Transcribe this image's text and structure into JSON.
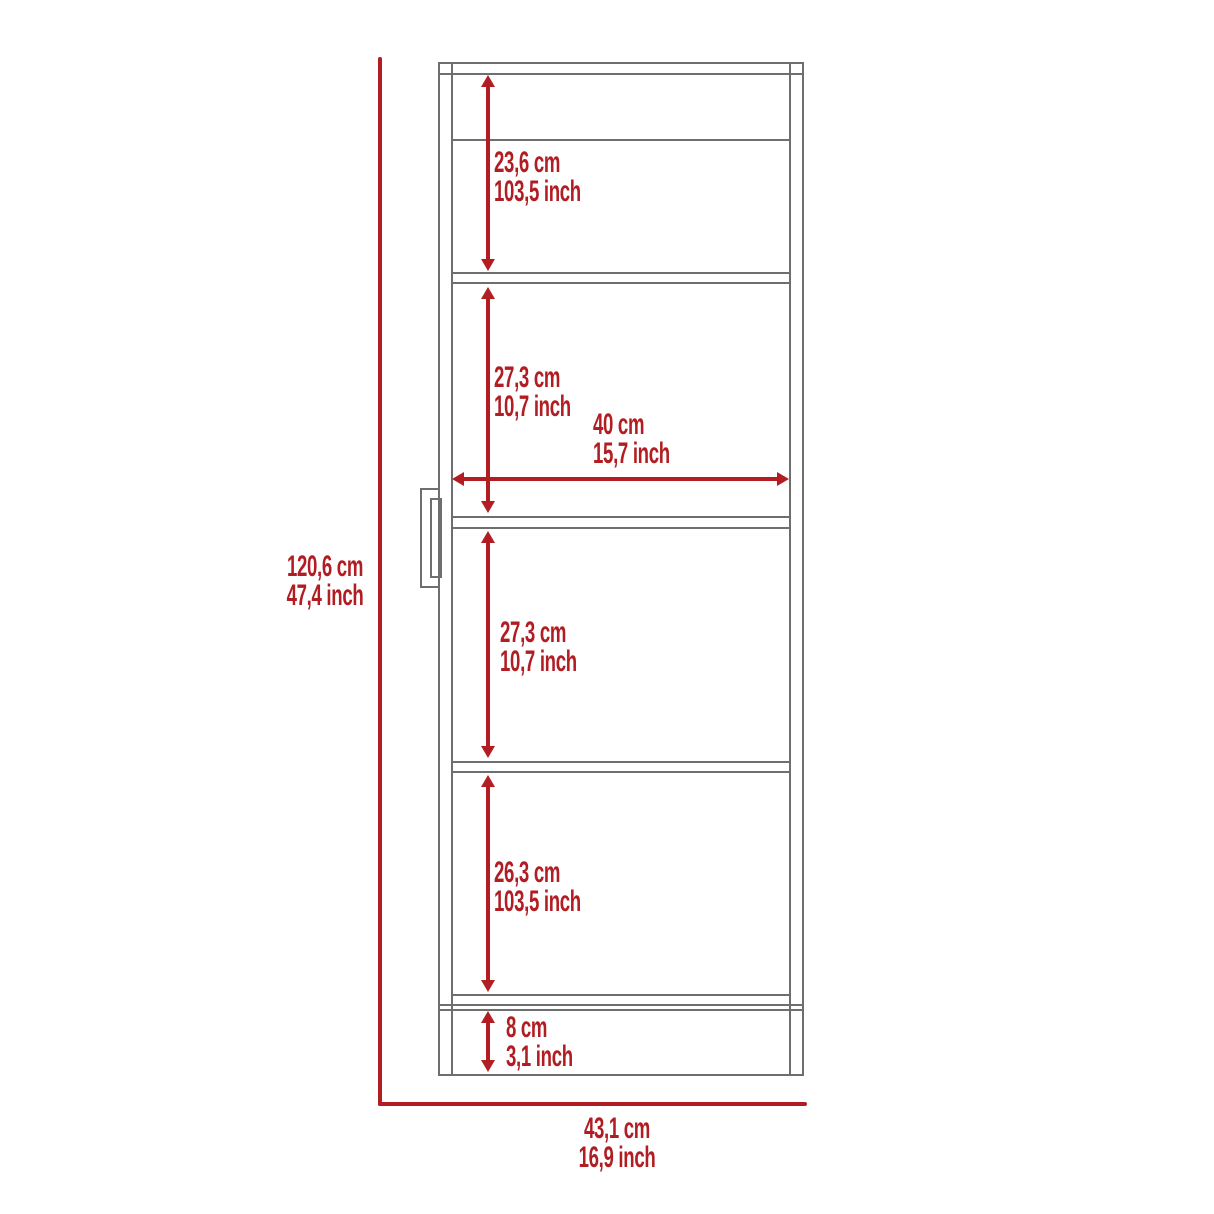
{
  "diagram": {
    "type": "furniture-dimension-drawing",
    "units": [
      "cm",
      "inch"
    ],
    "colors": {
      "dimension_red": "#b11d23",
      "outline_gray": "#6e6e6e",
      "background": "#ffffff"
    },
    "overall_height": {
      "cm": "120,6 cm",
      "inch": "47,4 inch"
    },
    "overall_width": {
      "cm": "43,1 cm",
      "inch": "16,9 inch"
    },
    "sections": [
      {
        "name": "top-shelf-height",
        "cm": "23,6 cm",
        "inch": "103,5 inch"
      },
      {
        "name": "second-shelf-height",
        "cm": "27,3 cm",
        "inch": "10,7 inch"
      },
      {
        "name": "interior-width",
        "cm": "40 cm",
        "inch": "15,7 inch"
      },
      {
        "name": "third-shelf-height",
        "cm": "27,3 cm",
        "inch": "10,7 inch"
      },
      {
        "name": "fourth-shelf-height",
        "cm": "26,3 cm",
        "inch": "103,5 inch"
      },
      {
        "name": "base-height",
        "cm": "8 cm",
        "inch": "3,1 inch"
      }
    ]
  }
}
